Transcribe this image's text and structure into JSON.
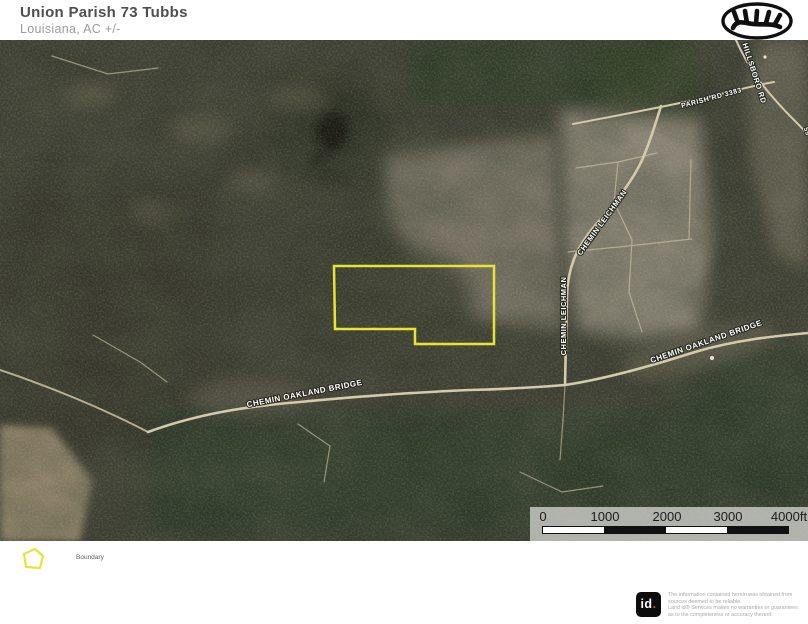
{
  "header": {
    "title": "Union Parish 73 Tubbs",
    "subtitle": "Louisiana,  AC +/-"
  },
  "brand": {
    "icon": "antler-oval-logo"
  },
  "map": {
    "boundary_color": "#e8e334",
    "road_color": "#d5c9ab",
    "road_labels": [
      {
        "id": "chemin-oakland-bridge-west",
        "text": "CHEMIN OAKLAND BRIDGE"
      },
      {
        "id": "chemin-oakland-bridge-east",
        "text": "CHEMIN OAKLAND BRIDGE"
      },
      {
        "id": "chemin-leichman-upper",
        "text": "CHEMIN LEICHMAN"
      },
      {
        "id": "chemin-leichman-lower",
        "text": "CHEMIN LEICHMAN"
      },
      {
        "id": "parish-rd-3383",
        "text": "PARISH RD 3383"
      },
      {
        "id": "hillsboro-rd",
        "text": "HILLSBORO RD"
      },
      {
        "id": "edge-road-fragment",
        "text": "55"
      }
    ]
  },
  "scale_bar": {
    "labels": [
      "0",
      "1000",
      "2000",
      "3000",
      "4000ft"
    ]
  },
  "legend": {
    "items": [
      {
        "label": "Boundary",
        "color": "#e8e334"
      }
    ]
  },
  "footer": {
    "logo_text": "id",
    "logo_dot": ".",
    "disclaimer_lines": [
      "The information contained herein was obtained from",
      "sources deemed to be reliable.",
      "Land id® Services makes no warranties or guarantees",
      "as to the completeness or accuracy thereof."
    ]
  }
}
